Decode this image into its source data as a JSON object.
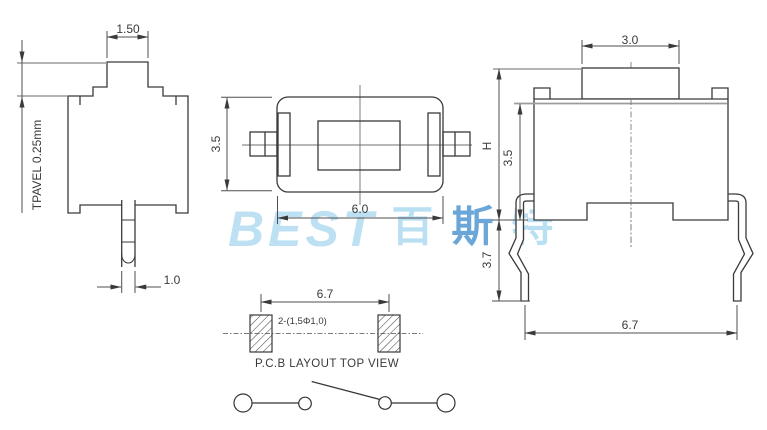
{
  "watermark": {
    "logo": "BEST",
    "cjk_chars": [
      "百",
      "斯",
      "特"
    ],
    "logo_color": "#bde1f3",
    "cjk_color": "#b9dff2",
    "cjk_mid_color": "#6ba6d9"
  },
  "views": {
    "front": {
      "dims": {
        "knob_width": "1.50",
        "travel": "TPAVEL 0.25mm",
        "pin_width": "1.0"
      }
    },
    "top": {
      "dims": {
        "body_depth": "3.5",
        "body_width": "6.0"
      }
    },
    "side": {
      "dims": {
        "knob_width": "3.0",
        "overall_height": "H",
        "body_height": "3.5",
        "lead_height": "3.7",
        "lead_span": "6.7"
      }
    },
    "pcb": {
      "dims": {
        "pad_pitch": "6.7",
        "hole_spec": "2-(1,5Φ1,0)"
      },
      "caption": "P.C.B LAYOUT TOP VIEW"
    }
  },
  "colors": {
    "outline": "#3a3a3a",
    "dimension": "#4f4f4f",
    "helper": "#9c9c9c"
  }
}
